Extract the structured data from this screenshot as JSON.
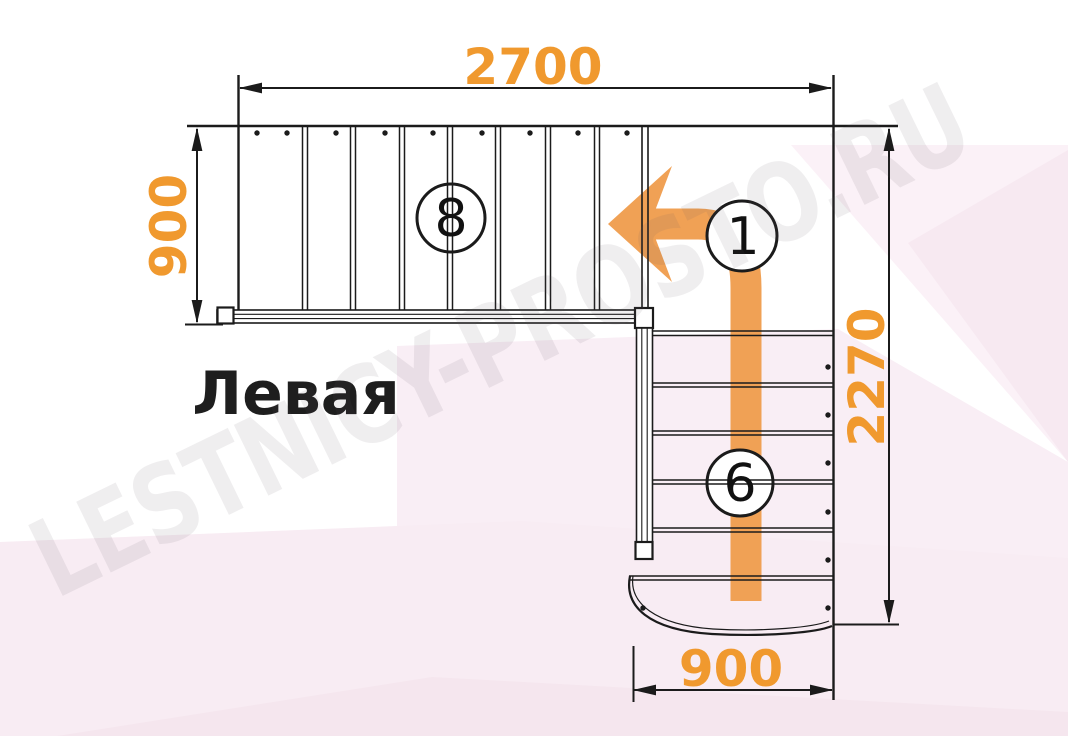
{
  "title": {
    "text": "Левая"
  },
  "watermark": {
    "text": "LESTNICY-PROSTO.RU"
  },
  "plan": {
    "type": "staircase-plan-top-view",
    "upper_flight": {
      "length_mm": "2700",
      "width_mm": "900",
      "step_count": "8"
    },
    "lower_flight": {
      "total_length_mm": "2270",
      "width_mm": "900",
      "step_count": "6"
    },
    "first_step_label": "1",
    "colors": {
      "dimension_orange": "#F0992E",
      "arrow_orange": "#F0A155",
      "line_black": "#1B1B1B",
      "pink_light_1": "#FBF1F7",
      "pink_deep_1": "#F7E9F1",
      "pink_light_2": "#F9EEF5",
      "pink_band": "#F8ECF3",
      "pink_deep_2": "#F5E6EE"
    }
  }
}
